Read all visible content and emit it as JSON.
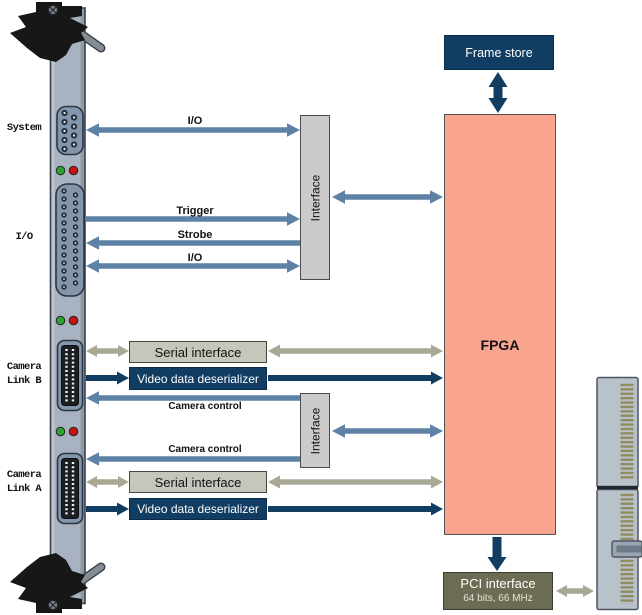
{
  "colors": {
    "steel_arrow": "#5e81a6",
    "olive_arrow": "#a9a895",
    "navy": "#113d63",
    "fpga_fill": "#f9a48f",
    "fpga_border": "#515151",
    "interface_fill": "#cbcbcb",
    "interface_border": "#4a4a4a",
    "serial_fill": "#c7c6bd",
    "pci_fill": "#6c6c55",
    "pci_border": "#3c3c2c",
    "bracket_fill": "#a8b2c0",
    "bracket_border": "#3a4350",
    "handle_black": "#171717",
    "connector_face": "#8496ab",
    "led_green": "#2da02d",
    "led_red": "#c11511",
    "edge_fill": "#b9c1cb",
    "edge_border": "#4e5662",
    "edge_pins": "#8f8c5a"
  },
  "panel_labels": {
    "system": "System",
    "io": "I/O",
    "camera_link_b_line1": "Camera",
    "camera_link_b_line2": "Link B",
    "camera_link_a_line1": "Camera",
    "camera_link_a_line2": "Link A"
  },
  "blocks": {
    "frame_store": "Frame store",
    "fpga": "FPGA",
    "interface_top": "Interface",
    "interface_bottom": "Interface",
    "serial_interface_b": "Serial interface",
    "video_deserializer_b": "Video data deserializer",
    "serial_interface_a": "Serial interface",
    "video_deserializer_a": "Video data deserializer",
    "pci_interface_title": "PCI interface",
    "pci_interface_subtitle": "64 bits, 66 MHz"
  },
  "signal_labels": {
    "io_system": "I/O",
    "trigger": "Trigger",
    "strobe": "Strobe",
    "io_secondary": "I/O",
    "camera_control_b": "Camera control",
    "camera_control_a": "Camera control"
  }
}
